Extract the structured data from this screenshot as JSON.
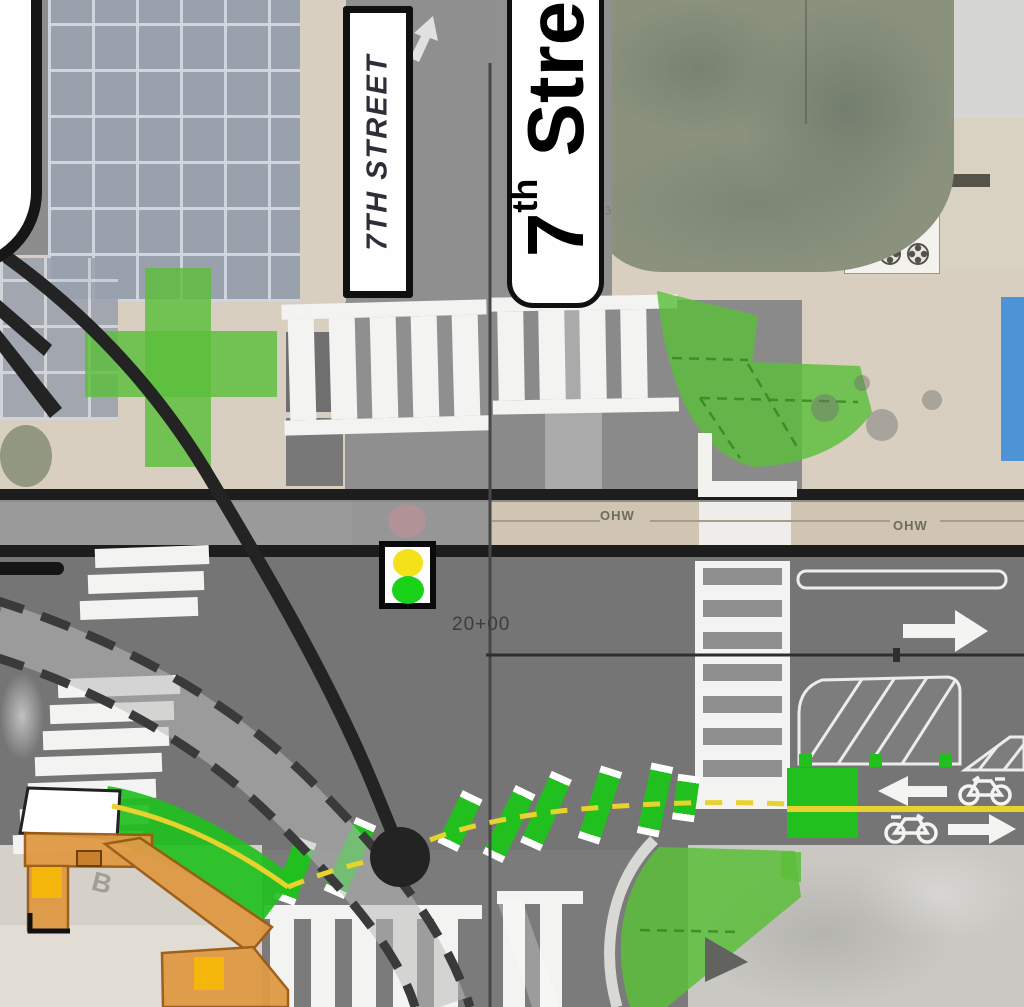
{
  "labels": {
    "small_street_sign": "7TH STREET",
    "large_street_sign_number": "7",
    "large_street_sign_ordinal": "th",
    "large_street_sign_name": "Stre",
    "station": "20+00",
    "overhead_wire_left": "OHW",
    "overhead_wire_right": "OHW",
    "parcel_number": "23",
    "building_letter": "B"
  },
  "colors": {
    "bike_lane_green": "#21c01f",
    "landscape_green": "rgba(92,190,58,0.82)",
    "platform_orange": "#df9a45",
    "platform_outline": "#9b5a12",
    "amenity_yellow": "#f4b60a",
    "centerline_yellow": "#e8d22e",
    "water_blue": "#4d93d6",
    "leader_black": "#232323",
    "road_gray": "#8d8d8d",
    "road_dark_gray": "#757575"
  },
  "icons": {
    "traffic_signal": "traffic-signal-icon",
    "bike": "bike-icon",
    "lane_arrow": "lane-arrow-icon",
    "callout_dot": "callout-leader-dot-icon"
  },
  "signal_lights": [
    "red",
    "yellow",
    "green"
  ],
  "markings": {
    "green_dashes": [
      [
        295,
        871,
        20,
        66
      ],
      [
        350,
        858,
        24,
        80
      ],
      [
        460,
        821,
        26,
        58
      ],
      [
        509,
        824,
        26,
        76
      ],
      [
        546,
        811,
        24,
        78
      ],
      [
        600,
        805,
        18,
        76
      ],
      [
        655,
        800,
        12,
        72
      ],
      [
        686,
        798,
        8,
        46
      ]
    ],
    "west_crosswalk_bars": [
      [
        547,
        95,
        114
      ],
      [
        573,
        88,
        116
      ],
      [
        599,
        80,
        118
      ],
      [
        677,
        58,
        122
      ],
      [
        703,
        50,
        124
      ],
      [
        729,
        43,
        126
      ],
      [
        755,
        35,
        127
      ],
      [
        781,
        28,
        128
      ],
      [
        807,
        20,
        129
      ],
      [
        833,
        13,
        130
      ]
    ],
    "crosswalks": [
      {
        "name": "crosswalk-north-left",
        "x": 283,
        "y": 302,
        "w": 205,
        "h": 131,
        "rot": -1.5,
        "rail": 15,
        "slat": 26,
        "gap": 15
      },
      {
        "name": "crosswalk-north-right",
        "x": 492,
        "y": 296,
        "w": 186,
        "h": 117,
        "rot": -1,
        "rail": 14,
        "slat": 26,
        "gap": 15
      },
      {
        "name": "crosswalk-south-left",
        "x": 264,
        "y": 905,
        "w": 218,
        "h": 130,
        "rot": 0,
        "rail": 14,
        "slat": 24,
        "gap": 17
      },
      {
        "name": "crosswalk-south-right",
        "x": 497,
        "y": 891,
        "w": 86,
        "h": 130,
        "rot": 0,
        "rail": 13,
        "slat": 22,
        "gap": 15
      }
    ],
    "east_band": {
      "x": 695,
      "y": 561,
      "w": 95,
      "h": 248,
      "slatH": 17,
      "gap": 15
    }
  }
}
